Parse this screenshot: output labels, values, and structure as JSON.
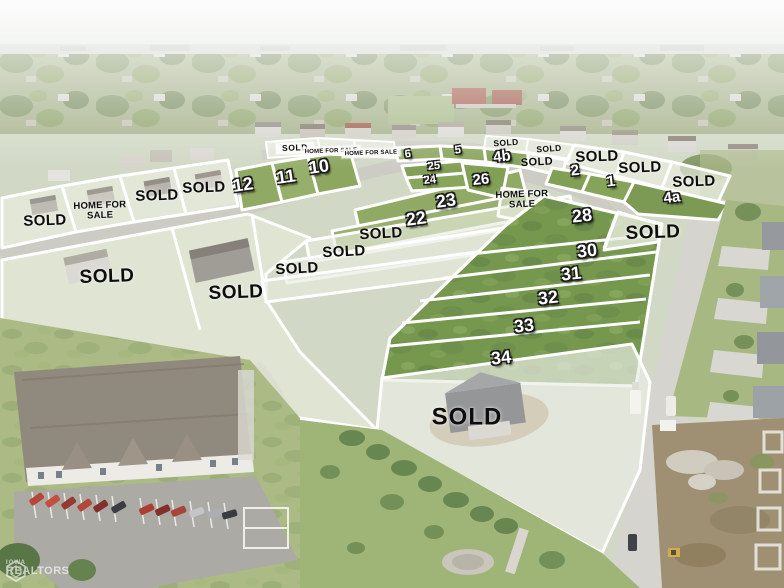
{
  "image": {
    "description": "Aerial drone photo of a residential subdivision with lot availability overlay",
    "width": 784,
    "height": 588
  },
  "legend": {
    "sold": "SOLD",
    "home_for_sale": "HOME FOR SALE"
  },
  "watermark": {
    "line1": "IOWA",
    "line2": "REALTORS"
  },
  "palette": {
    "lot_line": "#ffffff",
    "sold_text": "#0d0d0d",
    "number_text": "#ffffff",
    "available_grass": "#7b9a4c",
    "sold_overlay": "rgba(233,238,224,0.65)",
    "street": "#d3d2cb",
    "dirt": "#9b8a6b"
  },
  "lots": [
    {
      "name": "strip-label-sold",
      "text": "SOLD",
      "status": "sold",
      "type": "sold-box",
      "x": 295,
      "y": 148,
      "rot": -2
    },
    {
      "name": "strip-label-home-for-sale-1",
      "text": "HOME FOR SALE",
      "status": "for_sale",
      "type": "hfs-box",
      "x": 331,
      "y": 151,
      "rot": -2
    },
    {
      "name": "strip-label-home-for-sale-2",
      "text": "HOME FOR SALE",
      "status": "for_sale",
      "type": "hfs-box",
      "x": 371,
      "y": 153,
      "rot": -2
    },
    {
      "name": "lot-label-6",
      "text": "6",
      "status": "available",
      "type": "num-sm",
      "x": 408,
      "y": 155,
      "rot": -8
    },
    {
      "name": "lot-label-5",
      "text": "5",
      "status": "available",
      "type": "num-sm",
      "x": 458,
      "y": 151,
      "rot": -8
    },
    {
      "name": "sold-label-n1",
      "text": "SOLD",
      "status": "sold",
      "type": "sold-xs",
      "x": 506,
      "y": 143,
      "rot": -4
    },
    {
      "name": "lot-label-4b",
      "text": "4b",
      "status": "available",
      "type": "num-md",
      "x": 502,
      "y": 157,
      "rot": -6
    },
    {
      "name": "sold-label-n2",
      "text": "SOLD",
      "status": "sold",
      "type": "sold-xs",
      "x": 549,
      "y": 149,
      "rot": -4
    },
    {
      "name": "sold-label-strip-e",
      "text": "SOLD",
      "status": "sold",
      "type": "sold-sm2",
      "x": 537,
      "y": 163,
      "rot": -3
    },
    {
      "name": "sold-label-n3",
      "text": "SOLD",
      "status": "sold",
      "type": "sold-md",
      "x": 597,
      "y": 157,
      "rot": -2
    },
    {
      "name": "lot-label-2",
      "text": "2",
      "status": "available",
      "type": "num-md",
      "x": 575,
      "y": 171,
      "rot": -6
    },
    {
      "name": "sold-label-n4",
      "text": "SOLD",
      "status": "sold",
      "type": "sold-md",
      "x": 640,
      "y": 168,
      "rot": -2
    },
    {
      "name": "lot-label-1",
      "text": "1",
      "status": "available",
      "type": "num-md",
      "x": 611,
      "y": 182,
      "rot": -6
    },
    {
      "name": "sold-label-n5",
      "text": "SOLD",
      "status": "sold",
      "type": "sold-md",
      "x": 694,
      "y": 182,
      "rot": -2
    },
    {
      "name": "lot-label-4a",
      "text": "4a",
      "status": "available",
      "type": "num-md",
      "x": 672,
      "y": 198,
      "rot": -6
    },
    {
      "name": "lot-label-10",
      "text": "10",
      "status": "available",
      "type": "num-lg",
      "x": 319,
      "y": 167,
      "rot": -8
    },
    {
      "name": "lot-label-11",
      "text": "11",
      "status": "available",
      "type": "num-lg",
      "x": 286,
      "y": 177,
      "rot": -8
    },
    {
      "name": "lot-label-12",
      "text": "12",
      "status": "available",
      "type": "num-lg",
      "x": 243,
      "y": 185,
      "rot": -8
    },
    {
      "name": "lot-label-25",
      "text": "25",
      "status": "available",
      "type": "num-sm",
      "x": 434,
      "y": 167,
      "rot": -6
    },
    {
      "name": "lot-label-24",
      "text": "24",
      "status": "available",
      "type": "num-sm",
      "x": 430,
      "y": 181,
      "rot": -6
    },
    {
      "name": "lot-label-26",
      "text": "26",
      "status": "available",
      "type": "num-md",
      "x": 481,
      "y": 180,
      "rot": -6
    },
    {
      "name": "hfs-label-east",
      "text": "HOME FOR\nSALE",
      "status": "for_sale",
      "type": "hfs-2line",
      "x": 522,
      "y": 200,
      "rot": -2
    },
    {
      "name": "lot-label-23",
      "text": "23",
      "status": "available",
      "type": "num-lg",
      "x": 446,
      "y": 201,
      "rot": -8
    },
    {
      "name": "lot-label-22",
      "text": "22",
      "status": "available",
      "type": "num-lg",
      "x": 416,
      "y": 219,
      "rot": -8
    },
    {
      "name": "sold-label-band-1",
      "text": "SOLD",
      "status": "sold",
      "type": "sold-md",
      "x": 381,
      "y": 234,
      "rot": -3
    },
    {
      "name": "sold-label-band-2",
      "text": "SOLD",
      "status": "sold",
      "type": "sold-md",
      "x": 344,
      "y": 252,
      "rot": -3
    },
    {
      "name": "sold-label-band-3",
      "text": "SOLD",
      "status": "sold",
      "type": "sold-md",
      "x": 297,
      "y": 269,
      "rot": -3
    },
    {
      "name": "sold-label-big-w1",
      "text": "SOLD",
      "status": "sold",
      "type": "sold-lg",
      "x": 107,
      "y": 277,
      "rot": -2
    },
    {
      "name": "sold-label-big-w2",
      "text": "SOLD",
      "status": "sold",
      "type": "sold-lg",
      "x": 236,
      "y": 293,
      "rot": -2
    },
    {
      "name": "sold-label-p1",
      "text": "SOLD",
      "status": "sold",
      "type": "sold-md",
      "x": 45,
      "y": 221,
      "rot": -2
    },
    {
      "name": "hfs-label-west",
      "text": "HOME FOR\nSALE",
      "status": "for_sale",
      "type": "hfs-2line",
      "x": 100,
      "y": 211,
      "rot": -2
    },
    {
      "name": "sold-label-p3",
      "text": "SOLD",
      "status": "sold",
      "type": "sold-md",
      "x": 157,
      "y": 196,
      "rot": -2
    },
    {
      "name": "sold-label-p4",
      "text": "SOLD",
      "status": "sold",
      "type": "sold-md",
      "x": 204,
      "y": 188,
      "rot": -2
    },
    {
      "name": "lot-label-28",
      "text": "28",
      "status": "available",
      "type": "num-lg",
      "x": 582,
      "y": 216,
      "rot": -6
    },
    {
      "name": "sold-label-e",
      "text": "SOLD",
      "status": "sold",
      "type": "sold-lg",
      "x": 653,
      "y": 233,
      "rot": -2
    },
    {
      "name": "lot-label-30",
      "text": "30",
      "status": "available",
      "type": "num-lg",
      "x": 587,
      "y": 251,
      "rot": -6
    },
    {
      "name": "lot-label-31",
      "text": "31",
      "status": "available",
      "type": "num-lg",
      "x": 571,
      "y": 274,
      "rot": -6
    },
    {
      "name": "lot-label-32",
      "text": "32",
      "status": "available",
      "type": "num-lg",
      "x": 548,
      "y": 298,
      "rot": -6
    },
    {
      "name": "lot-label-33",
      "text": "33",
      "status": "available",
      "type": "num-lg",
      "x": 524,
      "y": 326,
      "rot": -6
    },
    {
      "name": "lot-label-34",
      "text": "34",
      "status": "available",
      "type": "num-lg",
      "x": 501,
      "y": 358,
      "rot": -6
    },
    {
      "name": "sold-label-s",
      "text": "SOLD",
      "status": "sold",
      "type": "sold-xl",
      "x": 467,
      "y": 417,
      "rot": 0
    }
  ]
}
